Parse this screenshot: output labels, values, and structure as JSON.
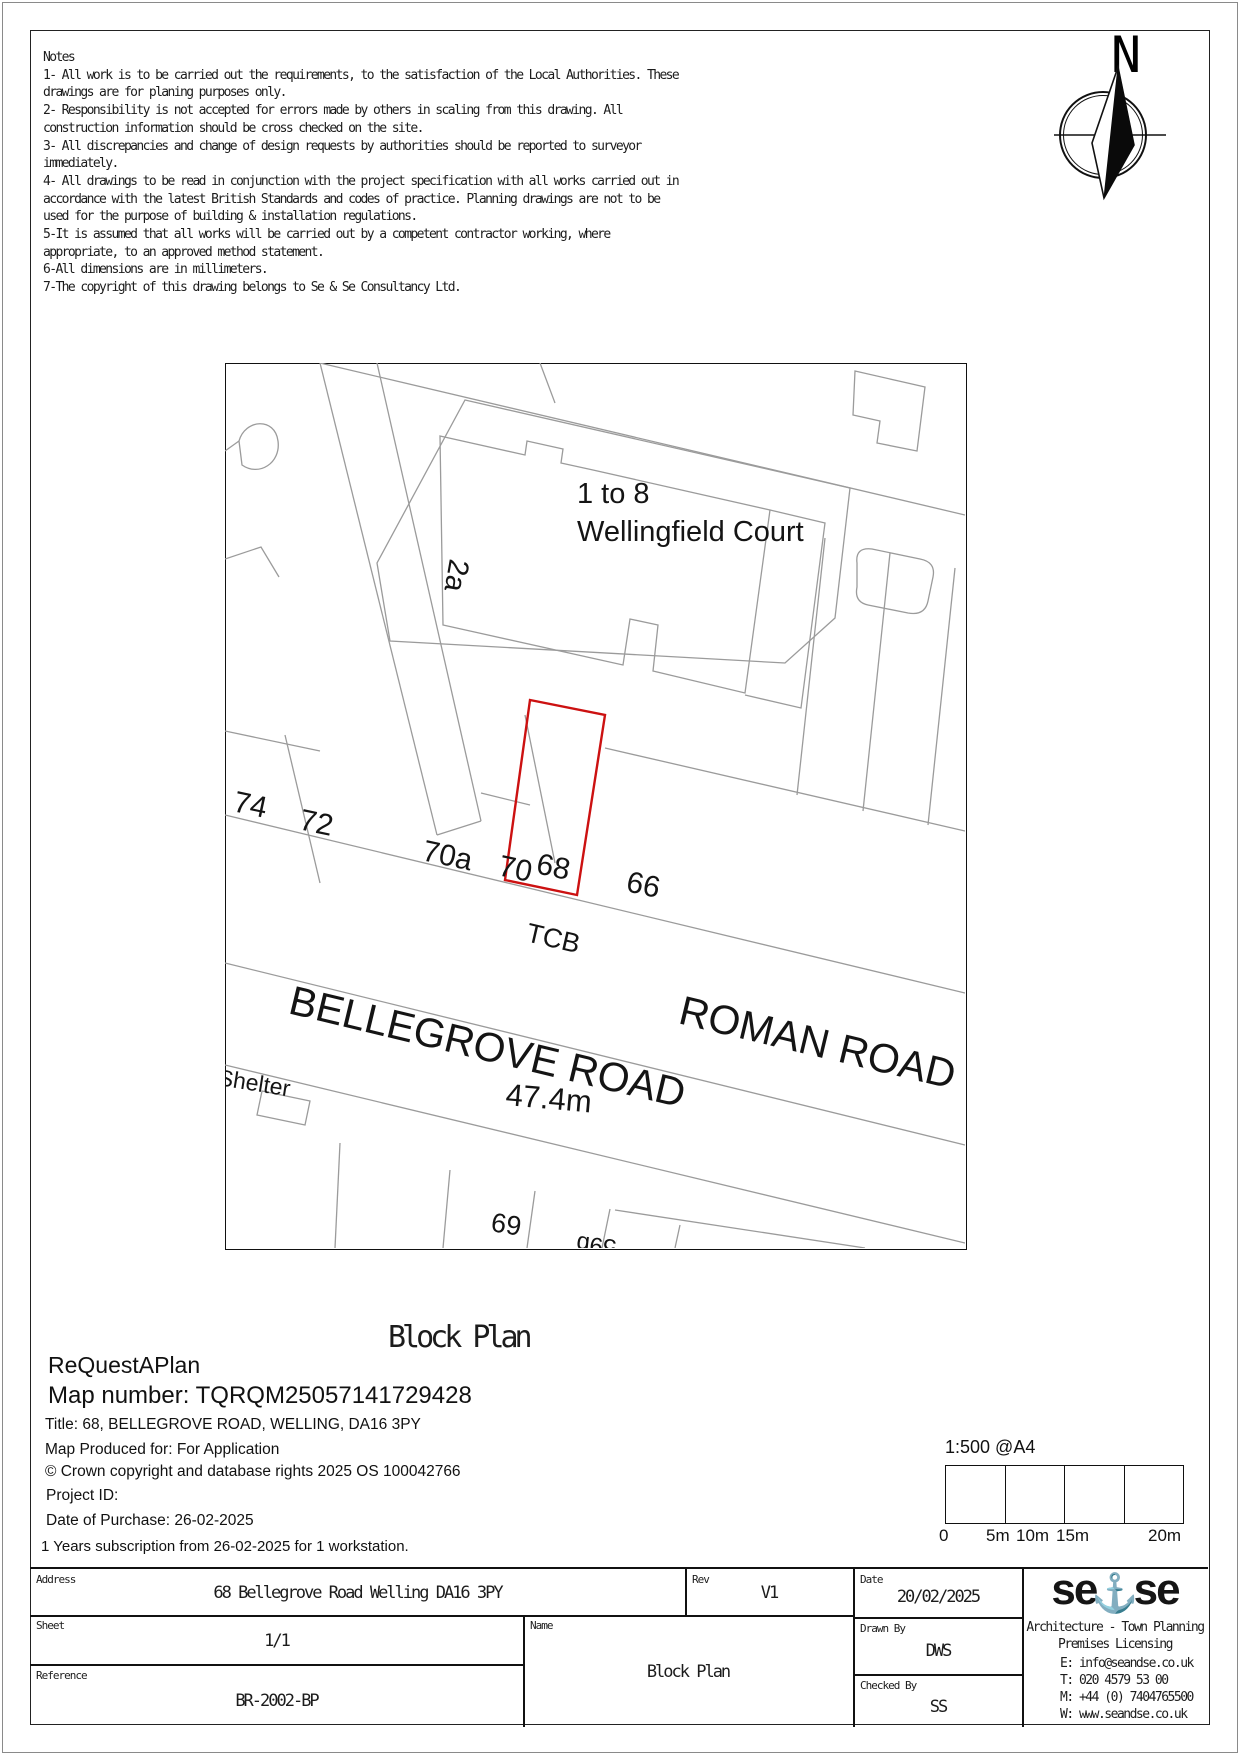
{
  "notes": {
    "lines": [
      "Notes",
      "1- All work is to be carried out the requirements, to the satisfaction of the Local Authorities. These",
      "drawings are for planing purposes only.",
      "2- Responsibility is not accepted for errors made by others in scaling from this drawing. All",
      "construction information should be cross checked on the site.",
      "3- All discrepancies and change of design requests by authorities should be reported to surveyor",
      "immediately.",
      "4- All drawings to be read in conjunction with the project specification with all works carried out in",
      "accordance with the latest British Standards and codes of practice. Planning drawings are not to be",
      "used for the purpose of building & installation regulations.",
      "5-It is assumed that all works will be carried out by a competent contractor working, where",
      "appropriate, to an approved method statement.",
      "6-All dimensions are in millimeters.",
      "7-The copyright of this drawing belongs to Se & Se Consultancy Ltd."
    ]
  },
  "compass": {
    "north_label": "N"
  },
  "map": {
    "highlight_color": "#cc1111",
    "labels": {
      "building_range": "1 to 8",
      "building_name": "Wellingfield Court",
      "plot_2a": "2a",
      "plot_74": "74",
      "plot_72": "72",
      "plot_70a": "70a",
      "plot_70": "70",
      "plot_68": "68",
      "plot_66": "66",
      "tcb": "TCB",
      "road_name_1": "BELLEGROVE ROAD",
      "road_name_2": "ROMAN ROAD",
      "road_width": "47.4m",
      "shelter": "Shelter",
      "plot_69": "69",
      "plot_59b": "59b"
    }
  },
  "plan_title": "Block Plan",
  "provider": {
    "name": "ReQuestAPlan",
    "map_number": "Map number: TQRQM25057141729428",
    "title_line": "Title: 68, BELLEGROVE ROAD, WELLING, DA16 3PY",
    "produced_for": "Map Produced for: For Application",
    "copyright": "© Crown copyright and database rights 2025 OS 100042766",
    "project_id": "Project ID:",
    "purchase_date": "Date of Purchase: 26-02-2025",
    "subscription": "1 Years subscription from 26-02-2025 for 1 workstation."
  },
  "scale_bar": {
    "scale_label": "1:500 @A4",
    "ticks": [
      "0",
      "5m",
      "10m",
      "15m",
      "20m"
    ]
  },
  "title_block": {
    "address_label": "Address",
    "address": "68 Bellegrove Road Welling DA16 3PY",
    "rev_label": "Rev",
    "rev": "V1",
    "date_label": "Date",
    "date": "20/02/2025",
    "sheet_label": "Sheet",
    "sheet": "1/1",
    "name_label": "Name",
    "name": "Block Plan",
    "drawn_label": "Drawn By",
    "drawn": "DWS",
    "reference_label": "Reference",
    "reference": "BR-2002-BP",
    "checked_label": "Checked By",
    "checked": "SS",
    "logo": {
      "part1": "se",
      "amp": "⚓",
      "part2": "se",
      "accent_color": "#9ed7e4",
      "tagline1": "Architecture - Town Planning",
      "tagline2": "Premises Licensing",
      "email": "E: info@seandse.co.uk",
      "tel": "T: 020 4579 53 00",
      "mobile": "M: +44 (0) 7404765500",
      "web": "W: www.seandse.co.uk"
    }
  }
}
